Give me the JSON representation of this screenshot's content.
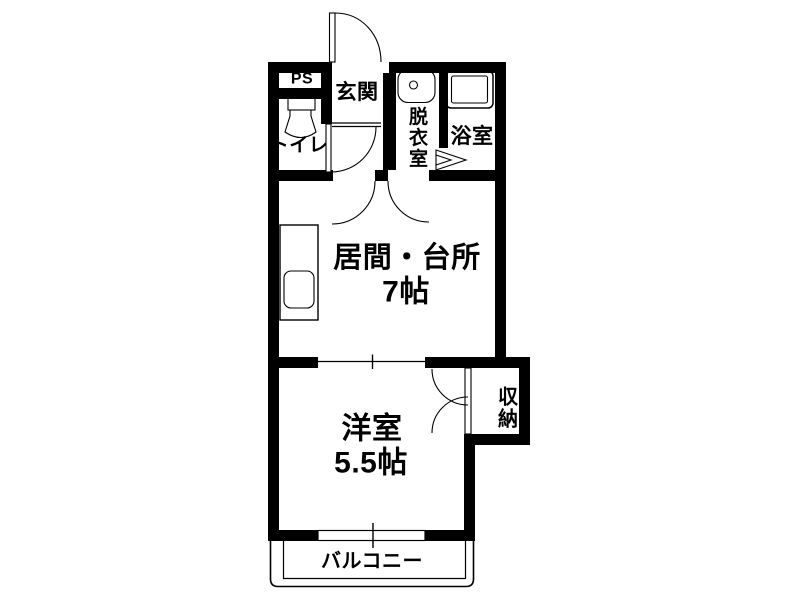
{
  "plan": {
    "type": "floor-plan",
    "background_color": "#ffffff",
    "wall_color": "#000000",
    "text_color": "#000000",
    "rooms": {
      "ps": {
        "label": "PS"
      },
      "entrance": {
        "label": "玄関"
      },
      "toilet": {
        "label": "トイレ"
      },
      "dressing_room": {
        "label": "脱衣室"
      },
      "bathroom": {
        "label": "浴室"
      },
      "living_kitchen": {
        "label": "居間・台所",
        "size": "7帖"
      },
      "western_room": {
        "label": "洋室",
        "size": "5.5帖"
      },
      "closet": {
        "label": "収納"
      },
      "balcony": {
        "label": "バルコニー"
      }
    },
    "fixtures": [
      "toilet-icon",
      "wash-basin-icon",
      "bathtub-icon",
      "kitchen-counter-sink-icon"
    ],
    "doors": [
      "entrance-swing-door",
      "toilet-swing-door",
      "hall-ldk-swing-door",
      "dressing-ldk-swing-door",
      "bathroom-folding-door",
      "closet-double-door"
    ],
    "openings": [
      "ldk-western-room-opening",
      "western-room-balcony-window"
    ]
  }
}
